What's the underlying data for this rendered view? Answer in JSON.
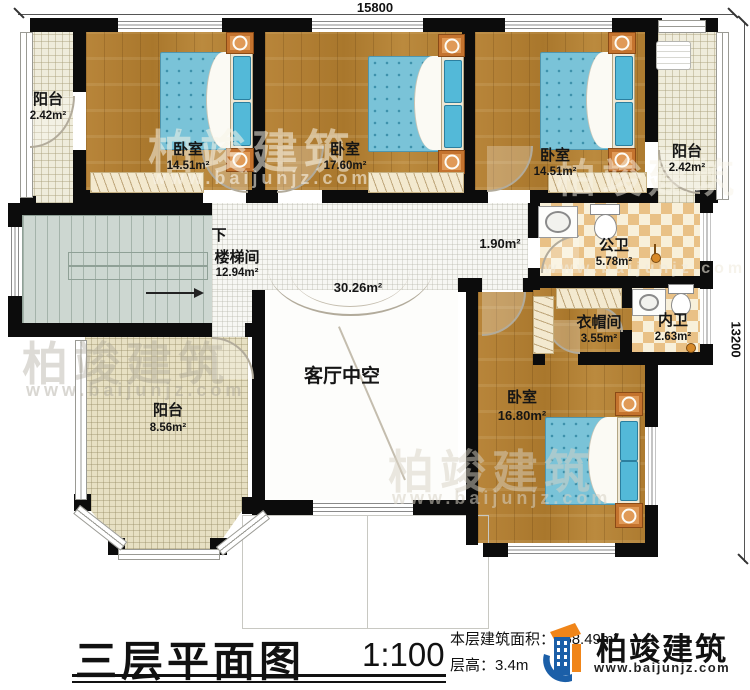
{
  "dimensions": {
    "top": "15800",
    "right": "13200"
  },
  "rooms": {
    "balcony_tl": {
      "name": "阳台",
      "area": "2.42m²"
    },
    "bedroom1": {
      "name": "卧室",
      "area": "14.51m²"
    },
    "bedroom2": {
      "name": "卧室",
      "area": "17.60m²"
    },
    "bedroom3": {
      "name": "卧室",
      "area": "14.51m²"
    },
    "balcony_tr": {
      "name": "阳台",
      "area": "2.42m²"
    },
    "stairwell": {
      "direction": "下",
      "name": "楼梯间",
      "area": "12.94m²"
    },
    "hallway": {
      "area": "1.90m²"
    },
    "void": {
      "name": "客厅中空",
      "area": "30.26m²"
    },
    "public_bath": {
      "name": "公卫",
      "area": "5.78m²"
    },
    "cloakroom": {
      "name": "衣帽间",
      "area": "3.55m²"
    },
    "private_bath": {
      "name": "内卫",
      "area": "2.63m²"
    },
    "bedroom4": {
      "name": "卧室",
      "area": "16.80m²"
    },
    "balcony_bl": {
      "name": "阳台",
      "area": "8.56m²"
    }
  },
  "title_block": {
    "title": "三层平面图",
    "scale": "1:100",
    "area_label": "本层建筑面积：",
    "area_value": "158.49m²",
    "height_label": "层高：",
    "height_value": "3.4m"
  },
  "brand": {
    "name": "柏竣建筑",
    "url": "www.baijunjz.com"
  },
  "watermark": {
    "name": "柏竣建筑",
    "url": "www.baijunjz.com"
  },
  "colors": {
    "wall": "#0c0c0c",
    "wood": "#b07e33",
    "bed": "#7ac3d8",
    "brand_blue": "#1b5fa8",
    "brand_orange": "#f08519"
  }
}
